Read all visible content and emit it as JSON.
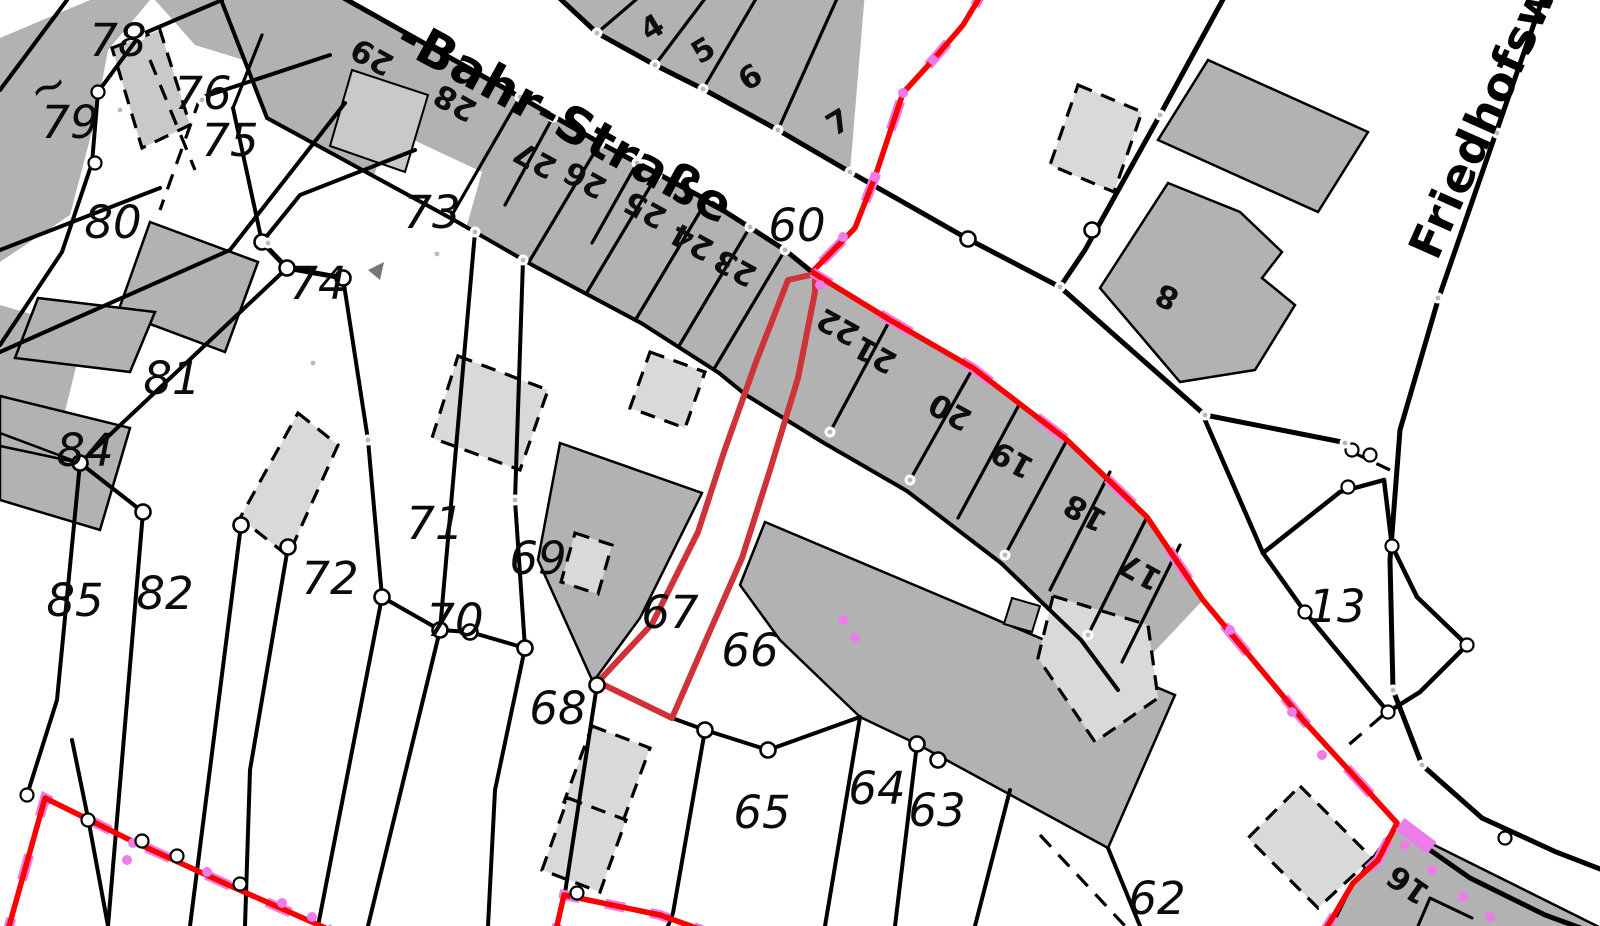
{
  "map": {
    "type_label": "Liegenschaftskarte (cadastral map view)",
    "streets": [
      {
        "name": "-Bahr-Straße",
        "x": 393,
        "y": 47,
        "rot": 28.5,
        "size": 50
      },
      {
        "name": "Friedhofsweg",
        "x": 1437,
        "y": 262,
        "rot": -66,
        "size": 46
      }
    ],
    "parcel_labels": [
      {
        "text": "78",
        "x": 118,
        "y": 40
      },
      {
        "text": "~",
        "x": 48,
        "y": 86,
        "rot": -20
      },
      {
        "text": "79",
        "x": 70,
        "y": 122
      },
      {
        "text": "76",
        "x": 203,
        "y": 93
      },
      {
        "text": "75",
        "x": 230,
        "y": 140
      },
      {
        "text": "80",
        "x": 113,
        "y": 222
      },
      {
        "text": "73",
        "x": 432,
        "y": 212
      },
      {
        "text": "74",
        "x": 318,
        "y": 283
      },
      {
        "text": "81",
        "x": 172,
        "y": 378
      },
      {
        "text": "84",
        "x": 85,
        "y": 450
      },
      {
        "text": "85",
        "x": 75,
        "y": 600
      },
      {
        "text": "82",
        "x": 165,
        "y": 593
      },
      {
        "text": "72",
        "x": 330,
        "y": 578
      },
      {
        "text": "71",
        "x": 435,
        "y": 523
      },
      {
        "text": "69",
        "x": 538,
        "y": 558
      },
      {
        "text": "70",
        "x": 455,
        "y": 620
      },
      {
        "text": "68",
        "x": 558,
        "y": 708
      },
      {
        "text": "67",
        "x": 670,
        "y": 612
      },
      {
        "text": "66",
        "x": 750,
        "y": 650
      },
      {
        "text": "65",
        "x": 762,
        "y": 812
      },
      {
        "text": "64",
        "x": 877,
        "y": 788
      },
      {
        "text": "63",
        "x": 937,
        "y": 810
      },
      {
        "text": "62",
        "x": 1157,
        "y": 898
      },
      {
        "text": "60",
        "x": 797,
        "y": 225
      },
      {
        "text": "13",
        "x": 1337,
        "y": 606
      }
    ],
    "house_numbers": [
      {
        "text": "29",
        "x": 372,
        "y": 57,
        "rot": 209
      },
      {
        "text": "28",
        "x": 455,
        "y": 103,
        "rot": 209
      },
      {
        "text": "27",
        "x": 535,
        "y": 160,
        "rot": 209
      },
      {
        "text": "26",
        "x": 585,
        "y": 180,
        "rot": 209
      },
      {
        "text": "25",
        "x": 645,
        "y": 210,
        "rot": 209
      },
      {
        "text": "24",
        "x": 692,
        "y": 242,
        "rot": 209
      },
      {
        "text": "23",
        "x": 735,
        "y": 268,
        "rot": 209
      },
      {
        "text": "22",
        "x": 838,
        "y": 327,
        "rot": 209
      },
      {
        "text": "21",
        "x": 875,
        "y": 355,
        "rot": 209
      },
      {
        "text": "20",
        "x": 950,
        "y": 412,
        "rot": 209
      },
      {
        "text": "19",
        "x": 1012,
        "y": 460,
        "rot": 209
      },
      {
        "text": "18",
        "x": 1085,
        "y": 513,
        "rot": 209
      },
      {
        "text": "17",
        "x": 1140,
        "y": 572,
        "rot": 209
      },
      {
        "text": "16",
        "x": 1408,
        "y": 885,
        "rot": 215
      },
      {
        "text": "8",
        "x": 1167,
        "y": 297,
        "rot": 205
      },
      {
        "text": "4",
        "x": 652,
        "y": 27,
        "rot": -31
      },
      {
        "text": "5",
        "x": 703,
        "y": 50,
        "rot": -31
      },
      {
        "text": "6",
        "x": 750,
        "y": 77,
        "rot": -31
      },
      {
        "text": "7",
        "x": 838,
        "y": 122,
        "rot": -31
      }
    ],
    "colors": {
      "background": "#ffffff",
      "boundary": "#000000",
      "parcel_fill": "#b2b2b2",
      "building_light_fill": "#d9d9d9",
      "building_midlight_fill": "#c9c9c9",
      "highlight_red": "#fa0000",
      "highlight_violet": "#ee7ce8",
      "parcel_outline_red": "#cf3238",
      "node_fill": "#ffffff",
      "node_dot": "#b9b9b9"
    }
  }
}
